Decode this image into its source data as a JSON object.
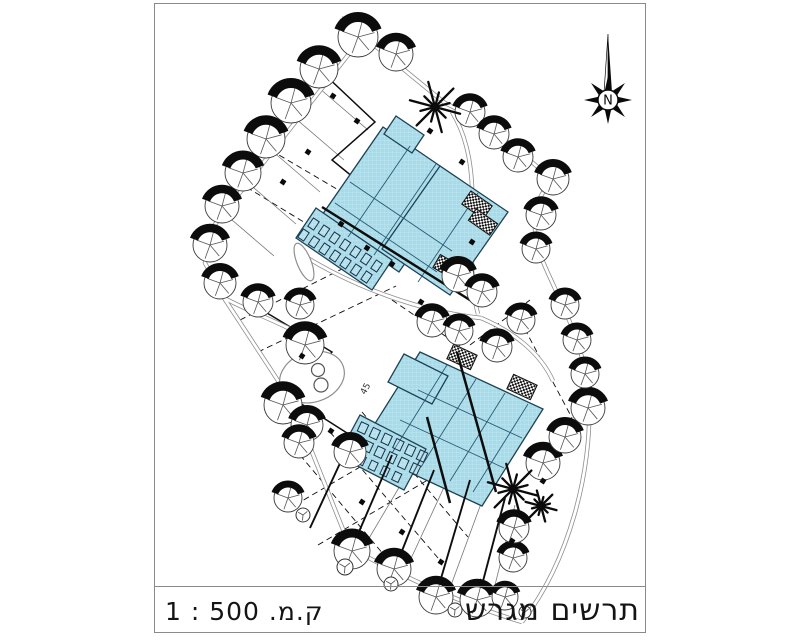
{
  "title_block": {
    "title": "תרשים מגרש",
    "scale": "ק.מ. 500 : 1"
  },
  "north_arrow": {
    "label": "N",
    "cx": 608,
    "cy": 100
  },
  "colors": {
    "building_fill": "#a6dbe9",
    "building_stroke": "#1d4256",
    "interior": "#2a5a74",
    "grid": "#c6ebf4",
    "road": "#8f8f8f",
    "ink": "#0d0d0d",
    "thin": "#777777"
  },
  "plan": {
    "dashed": [
      [
        240,
        320,
        370,
        255
      ],
      [
        258,
        352,
        396,
        286
      ],
      [
        300,
        455,
        405,
        580
      ],
      [
        330,
        432,
        438,
        558
      ],
      [
        362,
        412,
        468,
        537
      ],
      [
        295,
        505,
        420,
        432
      ],
      [
        318,
        545,
        448,
        468
      ],
      [
        262,
        145,
        352,
        198
      ],
      [
        238,
        182,
        330,
        238
      ],
      [
        392,
        300,
        460,
        346
      ],
      [
        520,
        320,
        572,
        418
      ],
      [
        470,
        345,
        530,
        300
      ]
    ],
    "thin": [
      [
        312,
        82,
        368,
        130
      ],
      [
        288,
        112,
        344,
        160
      ],
      [
        264,
        144,
        320,
        192
      ],
      [
        240,
        176,
        296,
        224
      ],
      [
        218,
        208,
        274,
        256
      ],
      [
        365,
        545,
        420,
        452
      ],
      [
        408,
        565,
        452,
        470
      ],
      [
        450,
        588,
        486,
        490
      ],
      [
        490,
        605,
        515,
        505
      ]
    ],
    "zigzags": [
      [
        [
          322,
          72
        ],
        [
          375,
          122
        ],
        [
          332,
          160
        ],
        [
          396,
          212
        ],
        [
          352,
          252
        ]
      ],
      [
        [
          262,
          310
        ],
        [
          332,
          352
        ],
        [
          292,
          398
        ],
        [
          358,
          440
        ]
      ]
    ],
    "roads": [
      "M 374 22 L 209 232",
      "M 209 232 L 205 263 L 224 298",
      "M 224 298 L 292 402 L 348 542",
      "M 340 542 C 385 568 455 602 522 622",
      "M 522 622 C 570 560 592 470 589 400 C 586 344 558 298 544 264 C 531 237 532 206 546 188",
      "M 443 102 C 482 120 522 152 553 181",
      "M 341 18 L 446 104",
      "M 298 252 C 352 287 422 312 481 318",
      "M 452 112 C 489 172 461 252 478 314",
      "M 481 318 C 512 331 540 352 553 381",
      "M 224 298 C 262 318 302 330 318 348"
    ],
    "ellipses": [
      {
        "cx": 312,
        "cy": 377,
        "rx": 33,
        "ry": 25,
        "a": -18
      },
      {
        "cx": 304,
        "cy": 262,
        "rx": 7,
        "ry": 20,
        "a": -22
      }
    ],
    "sections": [
      [
        322,
        207,
        473,
        302
      ],
      [
        457,
        352,
        496,
        492
      ],
      [
        427,
        417,
        450,
        503
      ]
    ],
    "fences": [
      [
        352,
        548,
        392,
        455
      ],
      [
        396,
        566,
        434,
        470
      ],
      [
        437,
        592,
        470,
        480
      ],
      [
        478,
        600,
        505,
        498
      ],
      [
        310,
        528,
        348,
        446
      ]
    ],
    "buildings": [
      {
        "pts": [
          [
            383,
            127
          ],
          [
            462,
            181
          ],
          [
            399,
            272
          ],
          [
            320,
            218
          ]
        ]
      },
      {
        "pts": [
          [
            440,
            166
          ],
          [
            508,
            212
          ],
          [
            450,
            295
          ],
          [
            382,
            249
          ]
        ]
      },
      {
        "pts": [
          [
            396,
            116
          ],
          [
            424,
            135
          ],
          [
            412,
            153
          ],
          [
            384,
            134
          ]
        ]
      },
      {
        "pts": [
          [
            316,
            208
          ],
          [
            392,
            260
          ],
          [
            372,
            290
          ],
          [
            296,
            238
          ]
        ]
      },
      {
        "pts": [
          [
            420,
            352
          ],
          [
            543,
            409
          ],
          [
            482,
            506
          ],
          [
            359,
            449
          ]
        ]
      },
      {
        "pts": [
          [
            360,
            415
          ],
          [
            426,
            449
          ],
          [
            404,
            490
          ],
          [
            338,
            456
          ]
        ]
      },
      {
        "pts": [
          [
            404,
            354
          ],
          [
            448,
            376
          ],
          [
            432,
            404
          ],
          [
            388,
            382
          ]
        ]
      }
    ],
    "interior": [
      [
        410,
        146,
        348,
        237
      ],
      [
        436,
        164,
        374,
        255
      ],
      [
        478,
        193,
        418,
        282
      ],
      [
        350,
        182,
        452,
        251
      ],
      [
        335,
        203,
        437,
        272
      ],
      [
        447,
        365,
        392,
        453
      ],
      [
        476,
        379,
        421,
        467
      ],
      [
        505,
        393,
        450,
        481
      ],
      [
        528,
        404,
        473,
        492
      ],
      [
        418,
        390,
        522,
        438
      ],
      [
        400,
        420,
        504,
        468
      ]
    ],
    "units": [
      {
        "x": 300,
        "y": 230,
        "n": 7,
        "dx": 10.5,
        "dy": 7,
        "w": 7,
        "h": 10,
        "a": 34
      },
      {
        "x": 310,
        "y": 219,
        "n": 7,
        "dx": 10.5,
        "dy": 7,
        "w": 7,
        "h": 10,
        "a": 34
      },
      {
        "x": 352,
        "y": 436,
        "n": 6,
        "dx": 11.8,
        "dy": 5.6,
        "w": 8,
        "h": 10,
        "a": 25
      },
      {
        "x": 359,
        "y": 423,
        "n": 6,
        "dx": 11.8,
        "dy": 5.6,
        "w": 8,
        "h": 10,
        "a": 25
      },
      {
        "x": 346,
        "y": 450,
        "n": 5,
        "dx": 11.8,
        "dy": 5.6,
        "w": 7,
        "h": 9,
        "a": 25
      }
    ],
    "hatch_pads": [
      [
        477,
        205,
        26,
        16,
        35
      ],
      [
        483,
        222,
        26,
        14,
        35
      ],
      [
        447,
        267,
        24,
        15,
        30
      ],
      [
        462,
        357,
        26,
        16,
        25
      ],
      [
        522,
        387,
        26,
        16,
        25
      ]
    ],
    "trees": [
      [
        358,
        37,
        20
      ],
      [
        319,
        69,
        19
      ],
      [
        291,
        103,
        20
      ],
      [
        266,
        139,
        19
      ],
      [
        243,
        173,
        18
      ],
      [
        222,
        206,
        17
      ],
      [
        210,
        245,
        17
      ],
      [
        220,
        283,
        16
      ],
      [
        258,
        302,
        15
      ],
      [
        300,
        305,
        14
      ],
      [
        305,
        345,
        19
      ],
      [
        283,
        405,
        19
      ],
      [
        307,
        425,
        16
      ],
      [
        299,
        443,
        15
      ],
      [
        350,
        452,
        16
      ],
      [
        288,
        498,
        14
      ],
      [
        352,
        551,
        18
      ],
      [
        394,
        569,
        17
      ],
      [
        436,
        597,
        17
      ],
      [
        477,
        600,
        17
      ],
      [
        505,
        597,
        13
      ],
      [
        513,
        558,
        14
      ],
      [
        514,
        528,
        15
      ],
      [
        543,
        463,
        17
      ],
      [
        565,
        437,
        16
      ],
      [
        588,
        408,
        17
      ],
      [
        585,
        374,
        14
      ],
      [
        577,
        340,
        14
      ],
      [
        565,
        305,
        14
      ],
      [
        536,
        249,
        14
      ],
      [
        541,
        215,
        15
      ],
      [
        553,
        179,
        16
      ],
      [
        470,
        112,
        15
      ],
      [
        494,
        134,
        15
      ],
      [
        518,
        157,
        15
      ],
      [
        396,
        54,
        17
      ],
      [
        458,
        276,
        16
      ],
      [
        482,
        292,
        15
      ],
      [
        432,
        322,
        15
      ],
      [
        459,
        331,
        14
      ],
      [
        497,
        347,
        15
      ],
      [
        521,
        320,
        14
      ]
    ],
    "palms": [
      [
        435,
        107,
        26
      ],
      [
        513,
        489,
        26
      ],
      [
        541,
        506,
        16
      ]
    ],
    "bushes": [
      [
        345,
        567,
        8
      ],
      [
        391,
        584,
        7
      ],
      [
        303,
        515,
        7
      ],
      [
        455,
        610,
        7
      ],
      [
        525,
        612,
        6
      ]
    ],
    "circles8": [
      [
        318,
        370,
        6.5
      ],
      [
        321,
        385,
        7
      ]
    ],
    "markers": [
      [
        333,
        96
      ],
      [
        357,
        121
      ],
      [
        308,
        152
      ],
      [
        283,
        182
      ],
      [
        341,
        224
      ],
      [
        367,
        248
      ],
      [
        392,
        264
      ],
      [
        421,
        302
      ],
      [
        302,
        356
      ],
      [
        331,
        431
      ],
      [
        362,
        502
      ],
      [
        402,
        532
      ],
      [
        441,
        562
      ],
      [
        481,
        582
      ],
      [
        512,
        541
      ],
      [
        543,
        481
      ],
      [
        562,
        421
      ],
      [
        472,
        242
      ],
      [
        462,
        162
      ],
      [
        430,
        131
      ]
    ],
    "labels": [
      {
        "t": "45",
        "x": 368,
        "y": 390,
        "a": -62,
        "s": 9
      }
    ]
  }
}
